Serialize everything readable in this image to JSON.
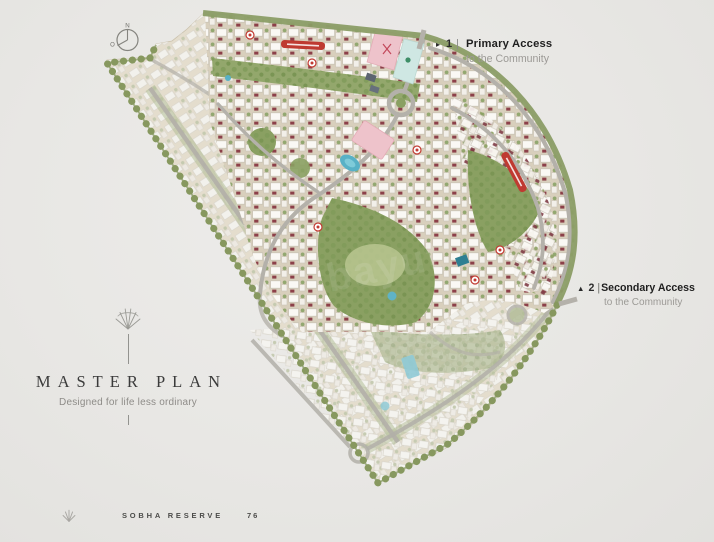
{
  "compass": {
    "north": "N",
    "west": "O"
  },
  "access_notes": {
    "primary": {
      "arrow": "▸",
      "number": "1",
      "divider": "|",
      "title": "Primary Access",
      "subtitle": "to the Community"
    },
    "secondary": {
      "arrow": "▲",
      "number": "2",
      "divider": "|",
      "title": "Secondary Access",
      "subtitle": "to the Community"
    }
  },
  "title_block": {
    "heading": "MASTER PLAN",
    "tagline": "Designed for life less ordinary"
  },
  "footer": {
    "brand": "SOBHA RESERVE",
    "page_number": "76"
  },
  "watermark": {
    "text": "bayut"
  },
  "colors": {
    "page_background": "#e8e7e4",
    "map_green": "#8b9d66",
    "accent_red_banner": "#bf3a31",
    "villa_maroon": "#8c4049",
    "clubhouse_pink": "#eec3cb",
    "pool_blue": "#58b1c6",
    "road_gray": "#b4b1aa"
  }
}
